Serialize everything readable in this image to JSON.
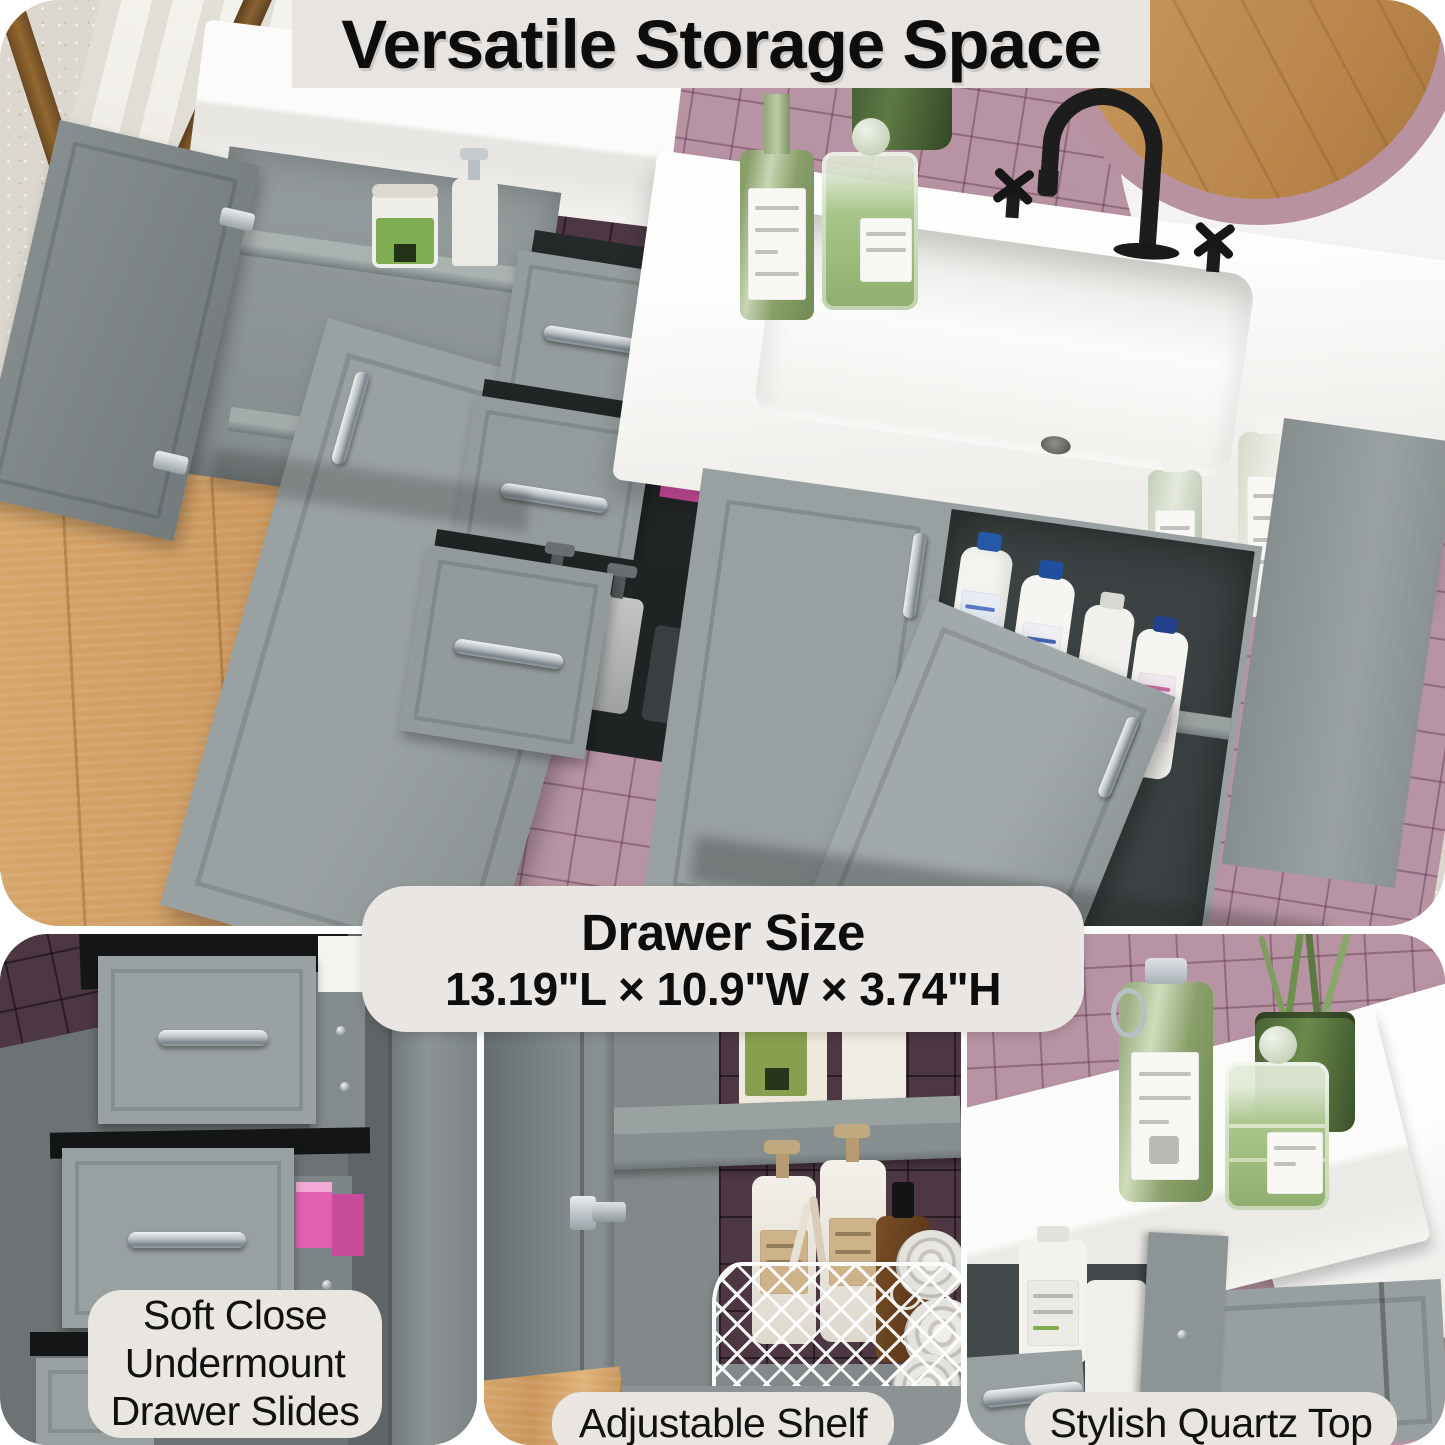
{
  "title": {
    "text": "Versatile Storage Space"
  },
  "drawer_size": {
    "heading": "Drawer Size",
    "dimensions": "13.19\"L × 10.9\"W × 3.74\"H"
  },
  "features": [
    {
      "label": "Soft Close Undermount Drawer Slides",
      "lines": [
        "Soft Close",
        "Undermount",
        "Drawer Slides"
      ]
    },
    {
      "label": "Adjustable Shelf",
      "lines": [
        "Adjustable Shelf"
      ]
    },
    {
      "label": "Stylish Quartz Top",
      "lines": [
        "Stylish Quartz Top"
      ]
    }
  ],
  "palette": {
    "background": "#ffffff",
    "banner_bg": "#e8e4e1",
    "caption_bg": "#e9e5e1",
    "text": "#0d0d0d",
    "cabinet_gray": "#99a0a1",
    "cabinet_gray_dark": "#6e7576",
    "tile_mauve": "#b793a3",
    "tile_dark": "#4c3742",
    "wood_floor": "#d0a067",
    "countertop_white": "#f5f4f1",
    "handle_silver": "#c3c9cd",
    "faucet_black": "#1d1d1d",
    "bottle_green": "#8aa06b"
  }
}
